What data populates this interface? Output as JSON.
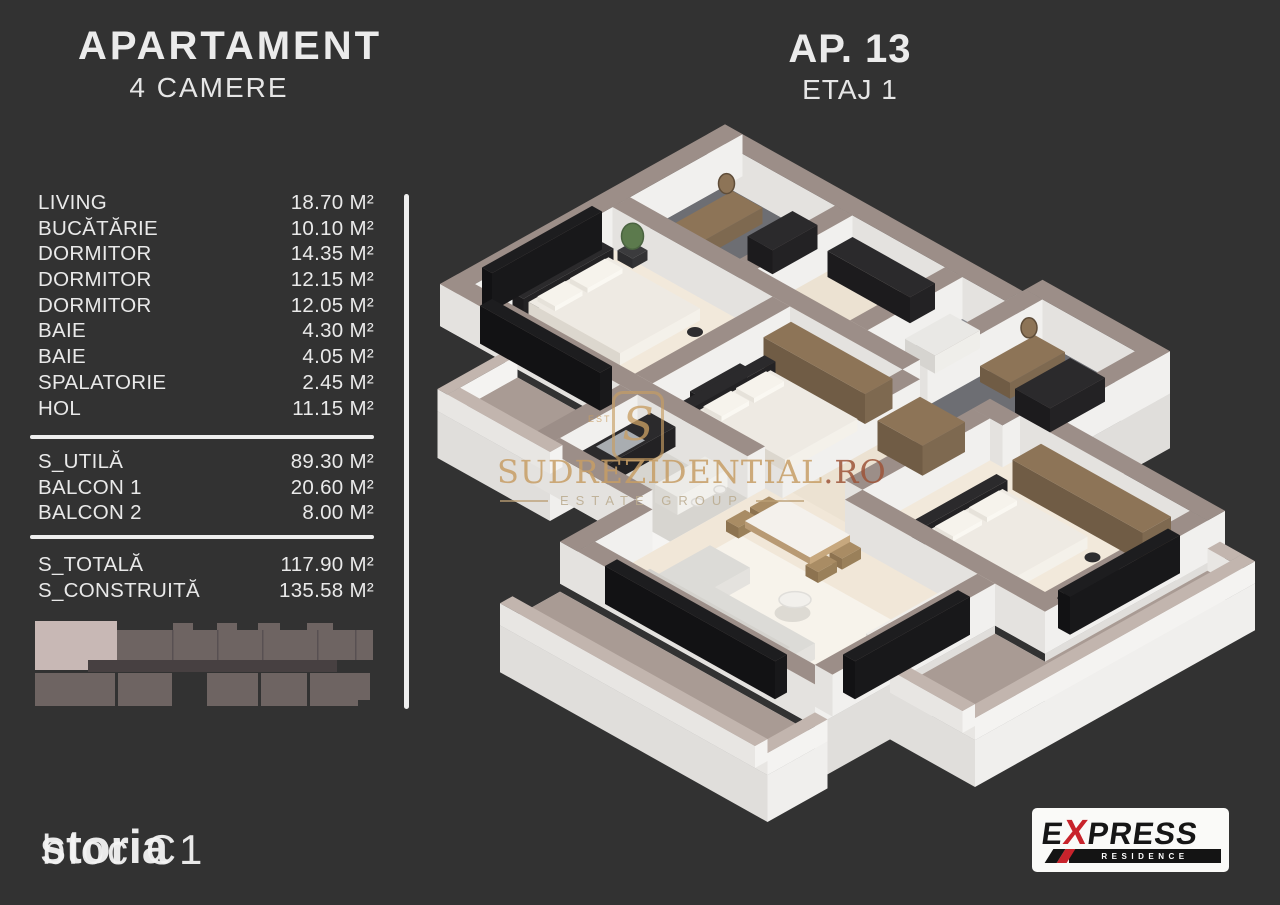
{
  "header": {
    "title": "APARTAMENT",
    "subtitle": "4 CAMERE",
    "apartment": "AP. 13",
    "floor": "ETAJ 1"
  },
  "area_table": {
    "rooms": [
      {
        "label": "LIVING",
        "value": "18.70 M²"
      },
      {
        "label": "BUCĂTĂRIE",
        "value": "10.10 M²"
      },
      {
        "label": "DORMITOR",
        "value": "14.35 M²"
      },
      {
        "label": "DORMITOR",
        "value": "12.15 M²"
      },
      {
        "label": "DORMITOR",
        "value": "12.05 M²"
      },
      {
        "label": "BAIE",
        "value": "4.30 M²"
      },
      {
        "label": "BAIE",
        "value": "4.05 M²"
      },
      {
        "label": "SPALATORIE",
        "value": "2.45 M²"
      },
      {
        "label": "HOL",
        "value": "11.15 M²"
      }
    ],
    "subtotals": [
      {
        "label": "S_UTILĂ",
        "value": "89.30 M²"
      },
      {
        "label": "BALCON 1",
        "value": "20.60 M²"
      },
      {
        "label": "BALCON 2",
        "value": "8.00 M²"
      }
    ],
    "totals": [
      {
        "label": "S_TOTALĂ",
        "value": "117.90 M²"
      },
      {
        "label": "S_CONSTRUITĂ",
        "value": "135.58 M²"
      }
    ]
  },
  "watermark": {
    "logo_letter": "S",
    "logo_side_text": "EST",
    "brand": "SUDREZIDENTIAL",
    "brand_tld": ".RO",
    "tagline": "ESTATE GROUP"
  },
  "footer": {
    "building_label": "bloc C1",
    "watermark_overlay": "storia"
  },
  "express_logo": {
    "part1": "E",
    "part2": "X",
    "part3": "PRESS",
    "line2": "RESIDENCE"
  },
  "building_section": {
    "highlighted_unit_color": "#c8b8b5",
    "unit_color": "#6e6462",
    "corridor_color": "#474041"
  },
  "colors": {
    "background": "#323232",
    "text": "#ececec",
    "divider": "#efefef",
    "accent_red": "#c8232b",
    "watermark_gold": "#c89e63",
    "wall_taupe": "#9c8e88",
    "balcony_floor": "#a99b94",
    "floor_cream": "#f1e7d8"
  }
}
